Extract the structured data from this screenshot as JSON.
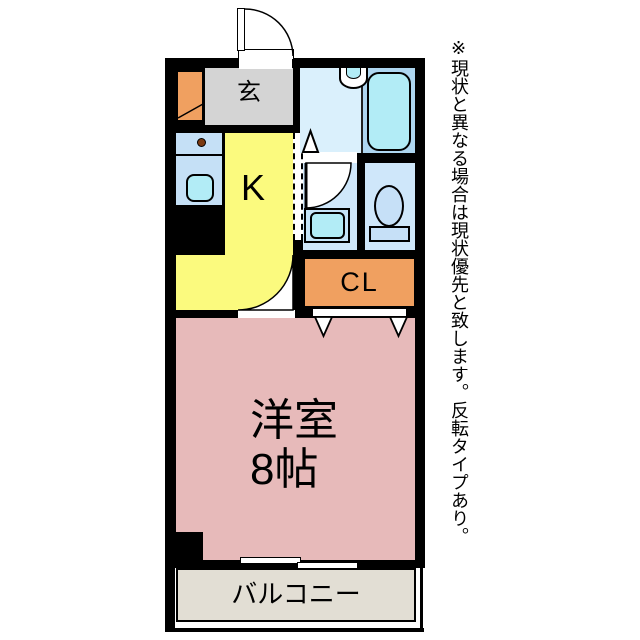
{
  "plan": {
    "rooms": {
      "genkan_label": "玄",
      "kitchen_label": "K",
      "closet_label": "CL",
      "western_room_label_line1": "洋室",
      "western_room_label_line2": "8帖",
      "balcony_label": "バルコニー"
    },
    "colors": {
      "wall": "#000000",
      "genkan": "#d4d4d4",
      "kitchen": "#fbfa7e",
      "western_room": "#e7baba",
      "closet": "#f0a060",
      "shoe_cabinet": "#f0a060",
      "bath": "#aed6f0",
      "washroom": "#daf0fc",
      "corridor_toilet": "#cfe7fa",
      "tub_sink": "#b2ecf6",
      "kitchen_counter": "#c5e0f6",
      "balcony": "#e2ded4",
      "stove_burner": "#7b3a12"
    },
    "fixtures": [
      "entrance-door",
      "shoe-cabinet",
      "kitchen-counter",
      "stove-burner",
      "kitchen-sink",
      "washbasin",
      "bathtub",
      "bath-door",
      "washing-machine-pan",
      "toilet",
      "closet-doors",
      "room-door",
      "sliding-window"
    ]
  },
  "annotation": {
    "note": "※現状と異なる場合は現状優先と致します。反転タイプあり。"
  }
}
